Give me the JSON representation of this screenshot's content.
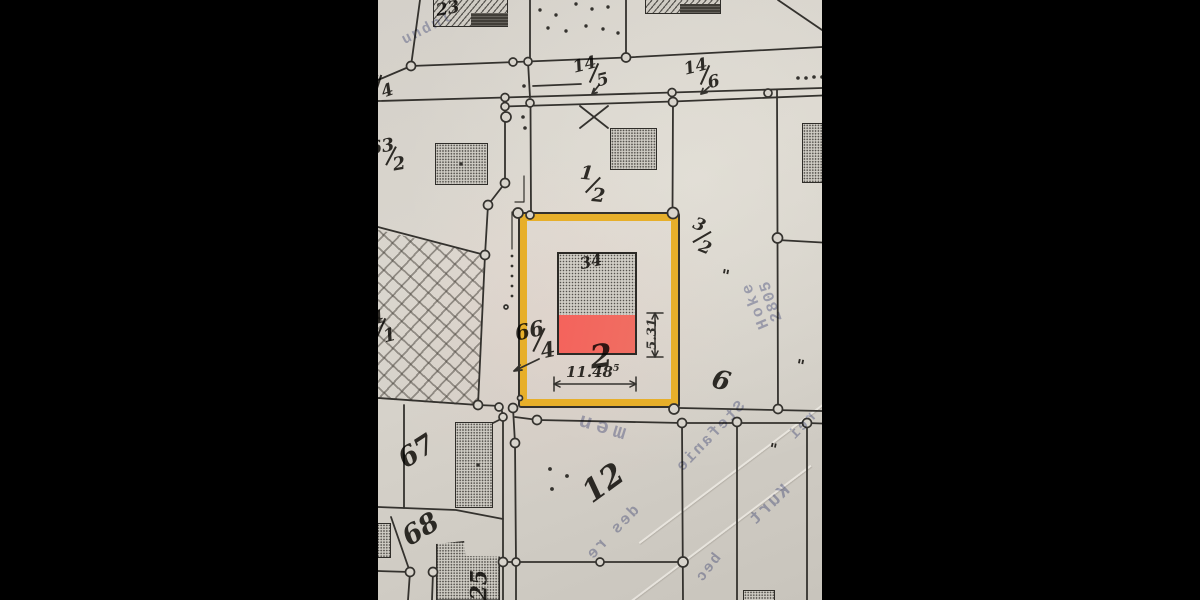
{
  "colors": {
    "paper": "#d7d3cb",
    "ink": "#34322e",
    "highlight_yellow": "#e7af2a",
    "highlight_red": "#f4635c",
    "bleed_blue": "#7078aa"
  },
  "map": {
    "type": "cadastral-parcel-map-photo",
    "parcel_labels": {
      "p23": "23",
      "p67": "67",
      "p68": "68",
      "p12": "12",
      "p2": "2",
      "p6": "6",
      "building34": "34",
      "building25": "25"
    },
    "fraction_labels": {
      "f14_4": {
        "num": "14",
        "den": "4"
      },
      "f14_5": {
        "num": "14",
        "den": "5"
      },
      "f14_6": {
        "num": "14",
        "den": "6"
      },
      "f63_2": {
        "num": "63",
        "den": "2"
      },
      "f1_2": {
        "num": "1",
        "den": "2"
      },
      "f3_2": {
        "num": "3",
        "den": "2"
      },
      "f64_1": {
        "num": "64",
        "den": "1"
      },
      "f66_4": {
        "num": "66",
        "den": "4"
      }
    },
    "measurements": {
      "width_value": "11.48",
      "width_sup": "5",
      "height_value": "5.31"
    },
    "marks": {
      "ditto": "\""
    },
    "bleed_through_text": {
      "stamp_top_left": "undnl",
      "field_12": "men",
      "hoke": "Hoke",
      "num_2805": "2805",
      "stefanie": "Stefanie",
      "kurt": "Kurt",
      "des_re": "des re",
      "rei": "rei",
      "bec": "bec"
    }
  }
}
